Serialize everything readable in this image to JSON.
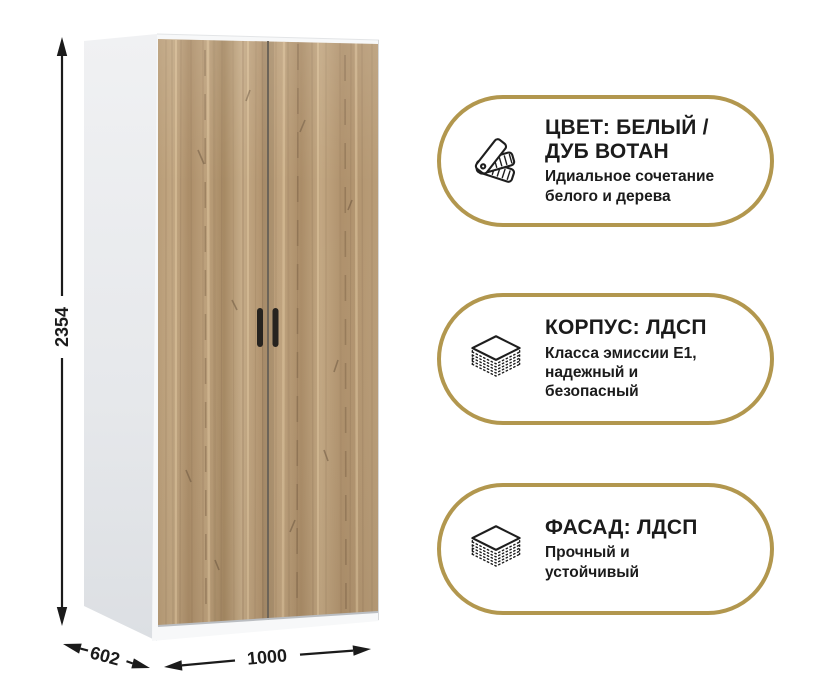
{
  "dimensions": {
    "height": "2354",
    "depth": "602",
    "width": "1000"
  },
  "badges": [
    {
      "title": "ЦВЕТ: БЕЛЫЙ /\nДУБ ВОТАН",
      "subtitle": "Идиальное сочетание\nбелого и дерева",
      "icon": "color-swatch-fan-icon"
    },
    {
      "title": "КОРПУС: ЛДСП",
      "subtitle": "Класса эмиссии Е1,\nнадежный и\nбезопасный",
      "icon": "layered-board-icon"
    },
    {
      "title": "ФАСАД: ЛДСП",
      "subtitle": "Прочный и\nустойчивый",
      "icon": "layered-board-icon"
    }
  ],
  "colors": {
    "badge_border": "#b2974e",
    "text": "#1b1b1b",
    "wood_base": "#b59a79",
    "side_panel": "#e6e8eb",
    "handle": "#26231f"
  }
}
